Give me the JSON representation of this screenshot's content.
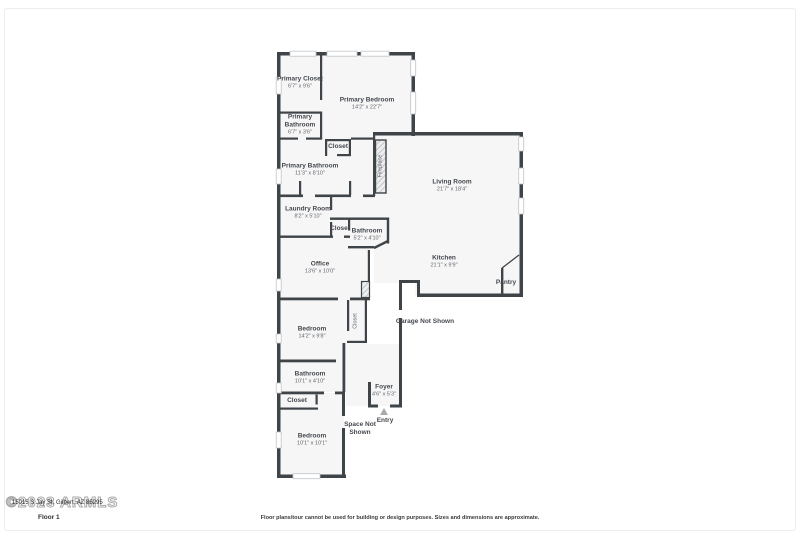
{
  "colors": {
    "wall": "#3f4449",
    "room_fill": "#f6f6f7",
    "label": "#44484d",
    "dims": "#62676c",
    "entry_arrow": "#a7abaf"
  },
  "labels": {
    "primary_closet": {
      "name": "Primary Closet",
      "dims": "6'7\" x 9'6\""
    },
    "primary_bedroom": {
      "name": "Primary Bedroom",
      "dims": "14'2\" x 22'7\""
    },
    "primary_bathroom_small": {
      "name": "Primary Bathroom",
      "dims": "6'7\" x 3'6\""
    },
    "closet_top": {
      "name": "Closet"
    },
    "primary_bathroom": {
      "name": "Primary Bathroom",
      "dims": "11'3\" x 8'10\""
    },
    "fireplace": {
      "name": "Fireplace"
    },
    "living_room": {
      "name": "Living Room",
      "dims": "21'7\" x 18'4\""
    },
    "laundry_room": {
      "name": "Laundry Room",
      "dims": "8'2\" x 5'10\""
    },
    "closet_mid": {
      "name": "Closet"
    },
    "bathroom_mid": {
      "name": "Bathroom",
      "dims": "5'2\" x 4'10\""
    },
    "office": {
      "name": "Office",
      "dims": "13'6\" x 10'0\""
    },
    "kitchen": {
      "name": "Kitchen",
      "dims": "21'1\" x 9'9\""
    },
    "pantry": {
      "name": "Pantry"
    },
    "garage": {
      "name": "Garage Not Shown"
    },
    "bedroom_mid": {
      "name": "Bedroom",
      "dims": "14'2\" x 9'8\""
    },
    "closet_vert": {
      "name": "Closet"
    },
    "bathroom_low": {
      "name": "Bathroom",
      "dims": "10'1\" x 4'10\""
    },
    "closet_low": {
      "name": "Closet"
    },
    "foyer": {
      "name": "Foyer",
      "dims": "4'6\" x 5'3\""
    },
    "entry": {
      "name": "Entry"
    },
    "space_not_shown": {
      "name": "Space Not Shown"
    },
    "bedroom_bottom": {
      "name": "Bedroom",
      "dims": "10'1\" x 10'1\""
    }
  },
  "footer": {
    "watermark": "©2023 ARMLS",
    "address": "15015 S Jay St, Gilbert, AZ 85295",
    "floor": "Floor 1",
    "disclaimer": "Floor plans/tour cannot be used for building or design purposes. Sizes and dimensions are approximate."
  }
}
